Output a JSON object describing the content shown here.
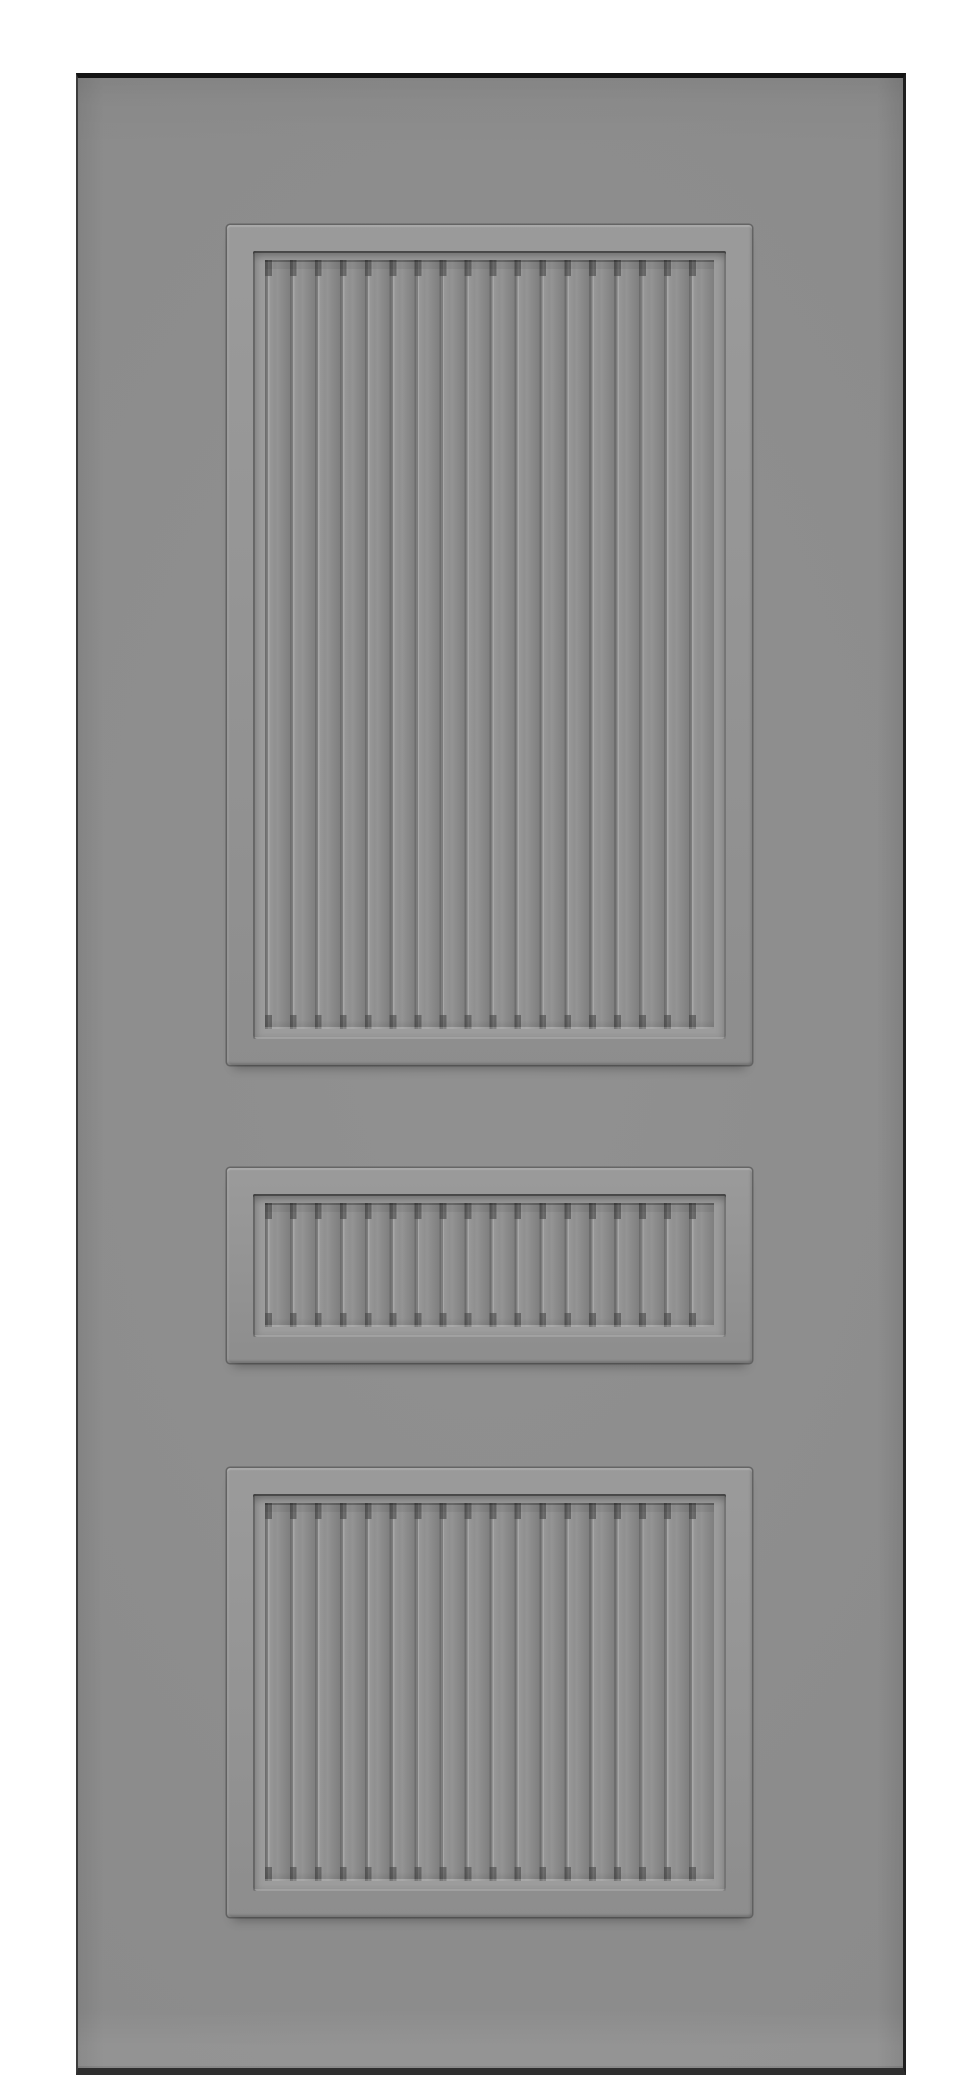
{
  "scene": {
    "subject": "Front view of a gray three-panel interior door slab on a plain white background; each panel is a raised molding frame with a recessed vertical beadboard slat field; no text, hardware, or labels visible",
    "background_color": "#ffffff",
    "door": {
      "left": 76,
      "top": 73,
      "width": 830,
      "height": 2002,
      "face_color": "#8e8e8e",
      "edge_colors": {
        "top": "#141414",
        "right": "#1f1f1f",
        "bottom": "#2e2e2e",
        "left": "#3c3c3c"
      }
    },
    "panel_colors": {
      "molding_face": "#939393",
      "outline": "rgba(35,35,35,0.38)",
      "recess_floor": "#9c9c9c",
      "slat_face": "#8f8f8f",
      "groove_dark": "#6d6d6d",
      "groove_mid": "#7d7d7d",
      "groove_highlight": "#a7a7a7",
      "notch_dark": "rgba(64,64,64,0.55)"
    },
    "panels": [
      {
        "name": "top-panel",
        "left": 149,
        "top": 147,
        "width": 525,
        "height": 840,
        "slat_count": 18,
        "slat_pitch_px": 24.94
      },
      {
        "name": "middle-panel",
        "left": 149,
        "top": 1090,
        "width": 525,
        "height": 195,
        "slat_count": 18,
        "slat_pitch_px": 24.94
      },
      {
        "name": "bottom-panel",
        "left": 149,
        "top": 1390,
        "width": 525,
        "height": 449,
        "slat_count": 18,
        "slat_pitch_px": 24.94
      }
    ]
  }
}
